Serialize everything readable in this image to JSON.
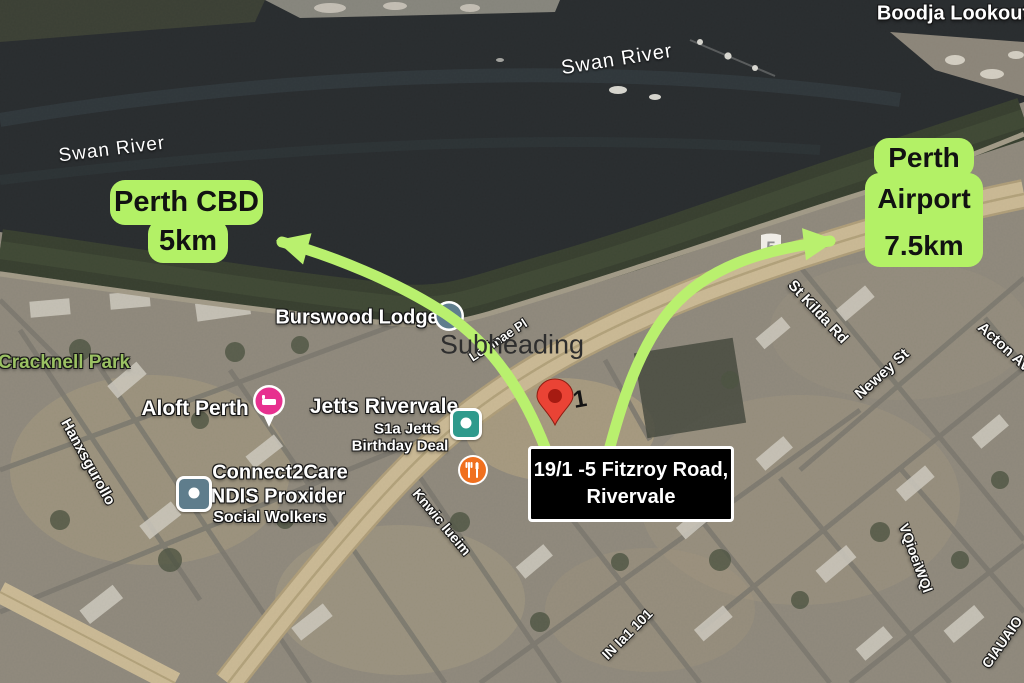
{
  "map_labels": {
    "boodja_lookout": "Boodja Lookout",
    "swan_river_upper": "Swan River",
    "swan_river_lower": "Swan River",
    "cracknell_park": "Cracknell Park",
    "burswood_lodge": "Burswood Lodge",
    "subheading_placeholder": "Subheading",
    "aloft_perth": "Aloft Perth",
    "jetts_rivervale": "Jetts Rivervale",
    "jetts_line2": "S1a Jetts",
    "jetts_line3": "Birthday Deal",
    "connect2care_line1": "Connect2Care",
    "connect2care_line2": "NDIS Proxider",
    "connect2care_line3": "Social Wolkers",
    "route_shield": "5",
    "house_number": "1"
  },
  "streets": {
    "st_kilda": "St Kilda Rd",
    "newey": "Newey St",
    "acton": "Acton Av",
    "lorimae": "Lorimae Pl",
    "garbled_left": "Hanxsgurollo",
    "garbled_jetts": "Knwic lueim",
    "garbled_bottom": "IN Ia1 101",
    "garbled_right": "VQioeiWQl",
    "garbled_corner": "CIAUAIO"
  },
  "callouts": {
    "perth_cbd": {
      "title": "Perth CBD",
      "distance": "5km"
    },
    "perth_airport": {
      "line1": "Perth",
      "line2": "Airport",
      "distance": "7.5km"
    },
    "address": {
      "line1": "19/1 -5 Fitzroy Road,",
      "line2": "Rivervale"
    }
  },
  "colors": {
    "callout_green": "#b3f166",
    "arrow_green": "#b9f06e",
    "pin_red": "#ea4335",
    "pin_inner_red": "#a61b12",
    "park_label_green": "#9bc163",
    "aloft_pink": "#e7308f",
    "teal_icon": "#2f9a8c",
    "restaurant_orange": "#f0701f",
    "poi_slate": "#5f7d8c",
    "address_box_bg": "#000000",
    "address_box_border": "#ffffff"
  }
}
